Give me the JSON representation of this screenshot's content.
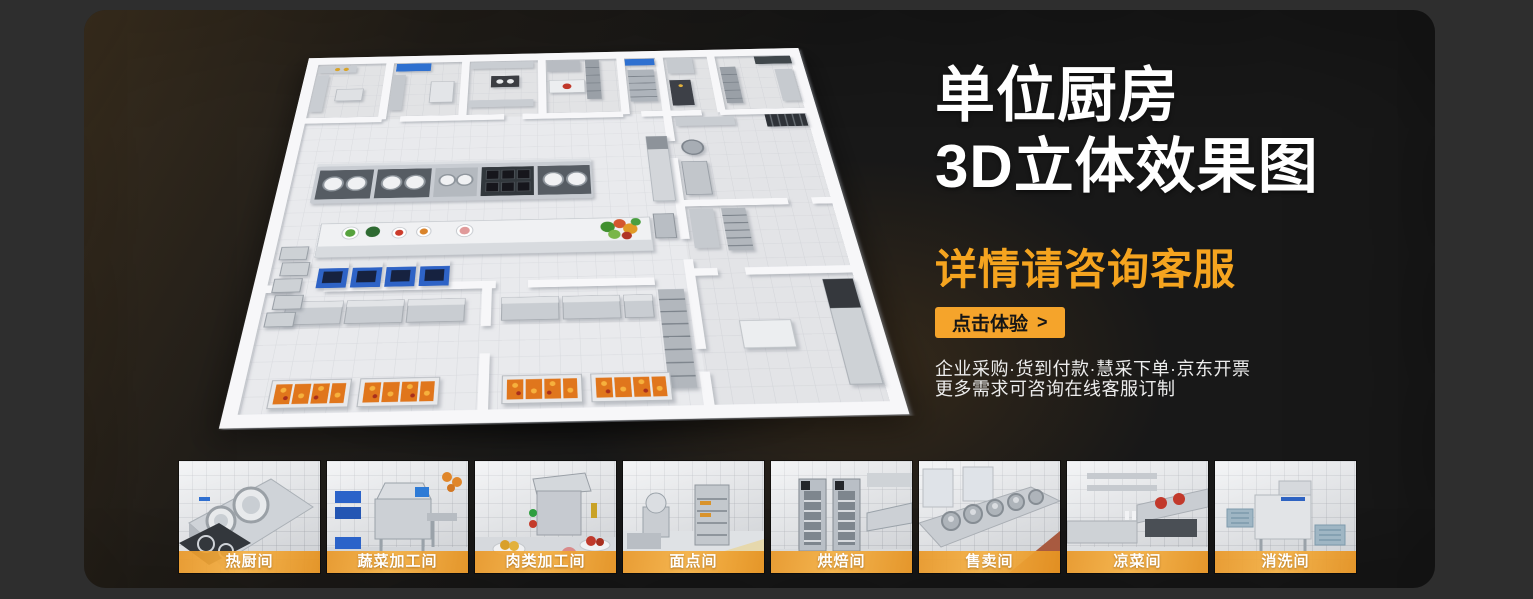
{
  "hero": {
    "title_line1": "单位厨房",
    "title_line2": "3D立体效果图",
    "subtitle": "详情请咨询客服",
    "cta_label": "点击体验",
    "cta_arrow": ">",
    "info_line1": "企业采购·货到付款·慧采下单·京东开票",
    "info_line2": "更多需求可咨询在线客服订制"
  },
  "gallery": {
    "items": [
      {
        "label": "热厨间",
        "icon": "hot-kitchen-photo"
      },
      {
        "label": "蔬菜加工间",
        "icon": "vegetable-processing-photo"
      },
      {
        "label": "肉类加工间",
        "icon": "meat-processing-photo"
      },
      {
        "label": "面点间",
        "icon": "pastry-room-photo"
      },
      {
        "label": "烘焙间",
        "icon": "baking-room-photo"
      },
      {
        "label": "售卖间",
        "icon": "sales-room-photo"
      },
      {
        "label": "凉菜间",
        "icon": "cold-dish-room-photo"
      },
      {
        "label": "消洗间",
        "icon": "washing-room-photo"
      }
    ]
  },
  "colors": {
    "accent_orange": "#F5A42B",
    "subtitle_orange": "#F5A41F",
    "label_band_orange": "#E99726",
    "panel_background": "#181818",
    "page_background": "#2E2E2E",
    "title_text": "#FFFFFF"
  }
}
